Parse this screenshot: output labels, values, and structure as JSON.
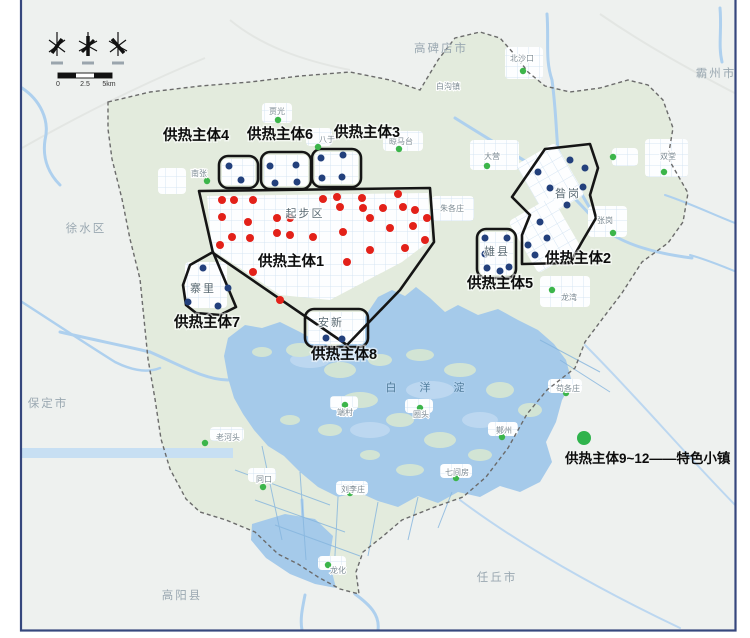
{
  "legend": {
    "text": "供热主体9~12——特色小镇",
    "dot_color": "#2fb34c",
    "dot_x": 584,
    "dot_y": 438
  },
  "scalebar": {
    "ticks": [
      {
        "text": "0",
        "x": 58,
        "y": 86
      },
      {
        "text": "2.5",
        "x": 85,
        "y": 86
      },
      {
        "text": "5km",
        "x": 109,
        "y": 86
      }
    ]
  },
  "colors": {
    "heat_source_dot": "#e32119",
    "entity_dot": "#23407c",
    "town_dot": "#3cb54a",
    "entity_outline": "#151515",
    "lake": "#a5caea",
    "region_inside": "#e3ebdd",
    "region_outside": "#eef1ef",
    "frame": "#36477d"
  },
  "entity_labels": [
    {
      "text": "供热主体1",
      "x": 291,
      "y": 266
    },
    {
      "text": "供热主体2",
      "x": 578,
      "y": 263
    },
    {
      "text": "供热主体3",
      "x": 367,
      "y": 137
    },
    {
      "text": "供热主体4",
      "x": 196,
      "y": 140
    },
    {
      "text": "供热主体5",
      "x": 500,
      "y": 288
    },
    {
      "text": "供热主体6",
      "x": 280,
      "y": 139
    },
    {
      "text": "供热主体7",
      "x": 207,
      "y": 327
    },
    {
      "text": "供热主体8",
      "x": 344,
      "y": 359
    }
  ],
  "region_labels": [
    {
      "text": "高碑店市",
      "x": 441,
      "y": 52
    },
    {
      "text": "霸州市",
      "x": 716,
      "y": 77
    },
    {
      "text": "徐水区",
      "x": 86,
      "y": 232
    },
    {
      "text": "保定市",
      "x": 48,
      "y": 407
    },
    {
      "text": "高阳县",
      "x": 182,
      "y": 599
    },
    {
      "text": "任丘市",
      "x": 497,
      "y": 581
    }
  ],
  "area_labels": [
    {
      "text": "起步区",
      "x": 305,
      "y": 217
    },
    {
      "text": "昝岗",
      "x": 568,
      "y": 197
    },
    {
      "text": "雄县",
      "x": 497,
      "y": 255
    },
    {
      "text": "安新",
      "x": 331,
      "y": 326
    },
    {
      "text": "寨里",
      "x": 203,
      "y": 292
    }
  ],
  "lake_label": {
    "text": "白 洋 淀",
    "x": 430,
    "y": 391
  },
  "town_labels": [
    {
      "text": "北沙口",
      "x": 522,
      "y": 61
    },
    {
      "text": "白沟镇",
      "x": 448,
      "y": 89
    },
    {
      "text": "贾光",
      "x": 277,
      "y": 114
    },
    {
      "text": "八于",
      "x": 327,
      "y": 142
    },
    {
      "text": "晾马台",
      "x": 401,
      "y": 144
    },
    {
      "text": "南张",
      "x": 199,
      "y": 176
    },
    {
      "text": "双堂",
      "x": 668,
      "y": 159
    },
    {
      "text": "大营",
      "x": 492,
      "y": 159
    },
    {
      "text": "朱各庄",
      "x": 452,
      "y": 211
    },
    {
      "text": "张岗",
      "x": 605,
      "y": 223
    },
    {
      "text": "龙湾",
      "x": 569,
      "y": 300
    },
    {
      "text": "同口",
      "x": 264,
      "y": 482
    },
    {
      "text": "刘李庄",
      "x": 353,
      "y": 492
    },
    {
      "text": "七间房",
      "x": 457,
      "y": 475
    },
    {
      "text": "鄚州",
      "x": 504,
      "y": 433
    },
    {
      "text": "苟各庄",
      "x": 568,
      "y": 391
    },
    {
      "text": "端村",
      "x": 345,
      "y": 415
    },
    {
      "text": "圈头",
      "x": 421,
      "y": 417
    },
    {
      "text": "老河头",
      "x": 228,
      "y": 440
    },
    {
      "text": "龙化",
      "x": 338,
      "y": 573
    }
  ],
  "dots": {
    "red": [
      [
        222,
        200
      ],
      [
        234,
        200
      ],
      [
        253,
        200
      ],
      [
        222,
        217
      ],
      [
        248,
        222
      ],
      [
        232,
        237
      ],
      [
        250,
        238
      ],
      [
        220,
        245
      ],
      [
        277,
        218
      ],
      [
        290,
        218
      ],
      [
        277,
        233
      ],
      [
        290,
        235
      ],
      [
        313,
        237
      ],
      [
        323,
        199
      ],
      [
        337,
        197
      ],
      [
        340,
        207
      ],
      [
        362,
        198
      ],
      [
        363,
        208
      ],
      [
        383,
        208
      ],
      [
        398,
        194
      ],
      [
        403,
        207
      ],
      [
        415,
        210
      ],
      [
        427,
        218
      ],
      [
        370,
        218
      ],
      [
        390,
        228
      ],
      [
        413,
        226
      ],
      [
        425,
        240
      ],
      [
        343,
        232
      ],
      [
        405,
        248
      ],
      [
        347,
        262
      ],
      [
        370,
        250
      ],
      [
        253,
        272
      ],
      [
        280,
        300
      ]
    ],
    "blue": [
      [
        229,
        166
      ],
      [
        241,
        180
      ],
      [
        270,
        166
      ],
      [
        296,
        165
      ],
      [
        275,
        183
      ],
      [
        297,
        182
      ],
      [
        321,
        158
      ],
      [
        343,
        155
      ],
      [
        322,
        178
      ],
      [
        342,
        177
      ],
      [
        485,
        238
      ],
      [
        507,
        238
      ],
      [
        485,
        254
      ],
      [
        487,
        268
      ],
      [
        500,
        271
      ],
      [
        509,
        267
      ],
      [
        326,
        338
      ],
      [
        342,
        339
      ],
      [
        203,
        268
      ],
      [
        188,
        302
      ],
      [
        218,
        306
      ],
      [
        228,
        288
      ],
      [
        570,
        160
      ],
      [
        538,
        172
      ],
      [
        585,
        168
      ],
      [
        550,
        188
      ],
      [
        583,
        187
      ],
      [
        567,
        205
      ],
      [
        540,
        222
      ],
      [
        547,
        238
      ],
      [
        528,
        245
      ],
      [
        535,
        255
      ]
    ],
    "green": [
      [
        523,
        71
      ],
      [
        278,
        120
      ],
      [
        318,
        147
      ],
      [
        399,
        149
      ],
      [
        207,
        181
      ],
      [
        664,
        172
      ],
      [
        613,
        233
      ],
      [
        552,
        290
      ],
      [
        487,
        166
      ],
      [
        613,
        157
      ],
      [
        263,
        487
      ],
      [
        350,
        493
      ],
      [
        456,
        478
      ],
      [
        502,
        437
      ],
      [
        566,
        393
      ],
      [
        328,
        565
      ],
      [
        205,
        443
      ],
      [
        345,
        405
      ],
      [
        420,
        408
      ]
    ]
  }
}
